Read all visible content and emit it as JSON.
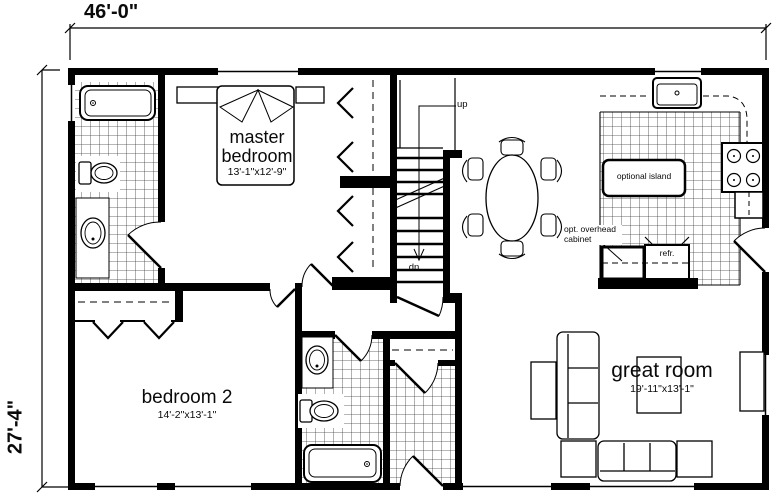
{
  "plan": {
    "dim_width": "46'-0\"",
    "dim_height": "27'-4\"",
    "rooms": {
      "master_bedroom": {
        "name": "master bedroom",
        "size": "13'-1\"x12'-9\""
      },
      "bedroom_2": {
        "name": "bedroom 2",
        "size": "14'-2\"x13'-1\""
      },
      "great_room": {
        "name": "great room",
        "size": "19'-11\"x13'-1\""
      }
    },
    "kitchen": {
      "island": "optional island",
      "overhead_cabinet": "opt. overhead cabinet",
      "refrigerator": "refr."
    },
    "stairs": {
      "up": "up",
      "down": "dn"
    },
    "colors": {
      "wall": "#000000",
      "background": "#ffffff"
    }
  }
}
